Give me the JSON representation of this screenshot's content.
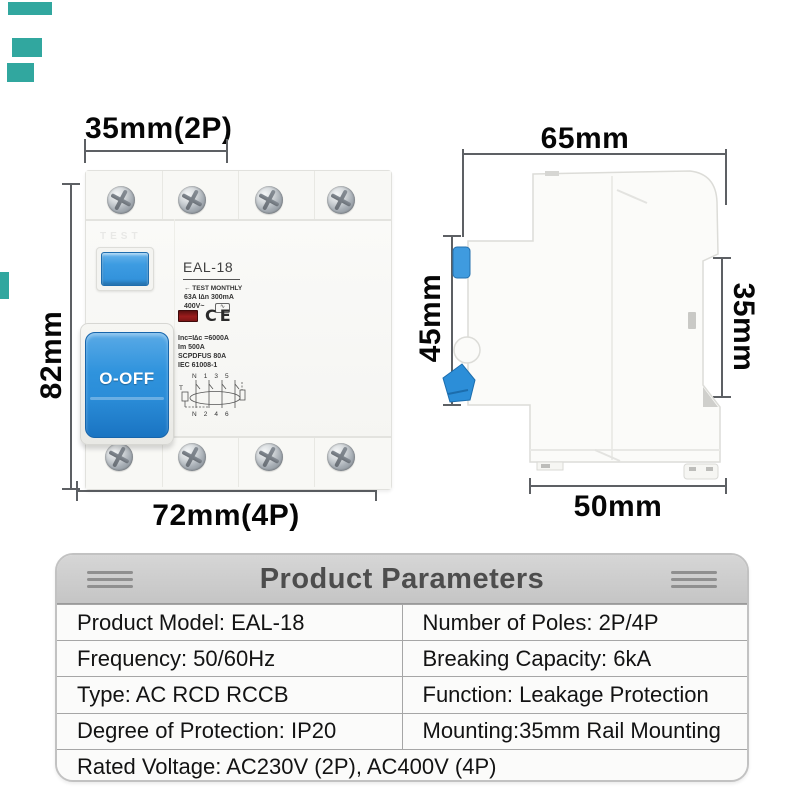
{
  "edge_marks": {
    "color": "#31a79f"
  },
  "front_view": {
    "dim_top": "35mm(2P)",
    "dim_left": "82mm",
    "dim_bottom": "72mm(4P)",
    "emboss": "TEST",
    "model": "EAL-18",
    "test_monthly": "← TEST MONTHLY",
    "rating_line": "63A  I∆n 300mA",
    "voltage_line": "400V~",
    "wave_symbol": "∿",
    "ce_mark": "CE",
    "spec1": "Inc=I∆c =6000A",
    "spec2": "Im 500A",
    "spec3": "SCPDFUS 80A",
    "spec4": "IEC 61008-1",
    "diagram_top": "N 1 3 5",
    "diagram_bottom": "N 2 4 6",
    "diagram_test": "T",
    "toggle_label": "O-OFF"
  },
  "side_view": {
    "dim_top": "65mm",
    "dim_left": "45mm",
    "dim_right": "35mm",
    "dim_bottom": "50mm"
  },
  "table": {
    "title": "Product Parameters",
    "rows": [
      {
        "left": "Product Model: EAL-18",
        "right": "Number of Poles: 2P/4P"
      },
      {
        "left": "Frequency: 50/60Hz",
        "right": "Breaking Capacity: 6kA"
      },
      {
        "left": "Type: AC RCD RCCB",
        "right": "Function: Leakage Protection"
      },
      {
        "left": "Degree of Protection: IP20",
        "right": "Mounting:35mm Rail Mounting"
      },
      {
        "full": "Rated Voltage: AC230V (2P), AC400V (4P)"
      }
    ]
  },
  "colors": {
    "accent_blue": "#2f93dd",
    "indicator_red": "#8e1b1b",
    "header_gray": "#cccccc",
    "teal": "#31a79f",
    "dim_line": "#5d6064"
  }
}
